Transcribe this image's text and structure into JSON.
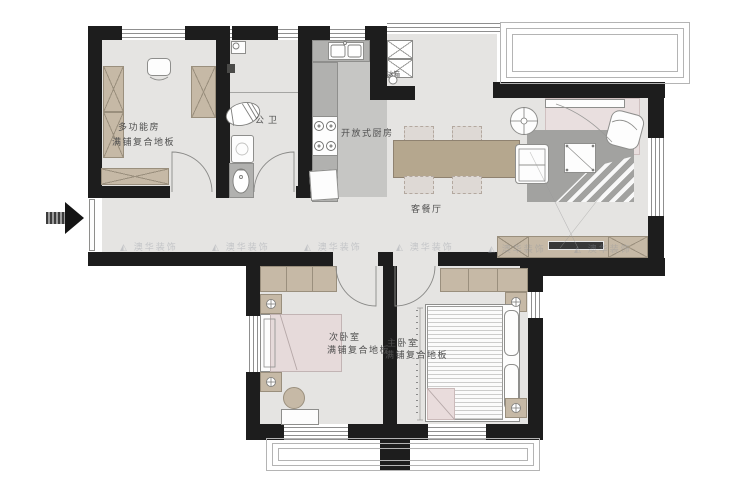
{
  "floor_plan": {
    "labels": {
      "multi_room": "多功能房",
      "multi_room_floor": "满铺复合地板",
      "bathroom": "公卫",
      "kitchen": "开放式厨房",
      "fridge": "冰箱",
      "living_dining": "客餐厅",
      "second_bedroom": "次卧室",
      "second_bedroom_floor": "满铺复合地板",
      "master_bedroom": "主卧室",
      "master_bedroom_floor": "满铺复合地板"
    },
    "watermark": {
      "logo": "◭",
      "text": "澳华装饰"
    },
    "colors": {
      "wall": "#1d1d1d",
      "floor": "#e5e4e2",
      "wood": "#c6b9a6",
      "counter": "#b1b1af",
      "rug_gray": "#a2a2a0",
      "rug_pink": "#e9dfdf",
      "blanket_pink": "#e6dada"
    }
  }
}
